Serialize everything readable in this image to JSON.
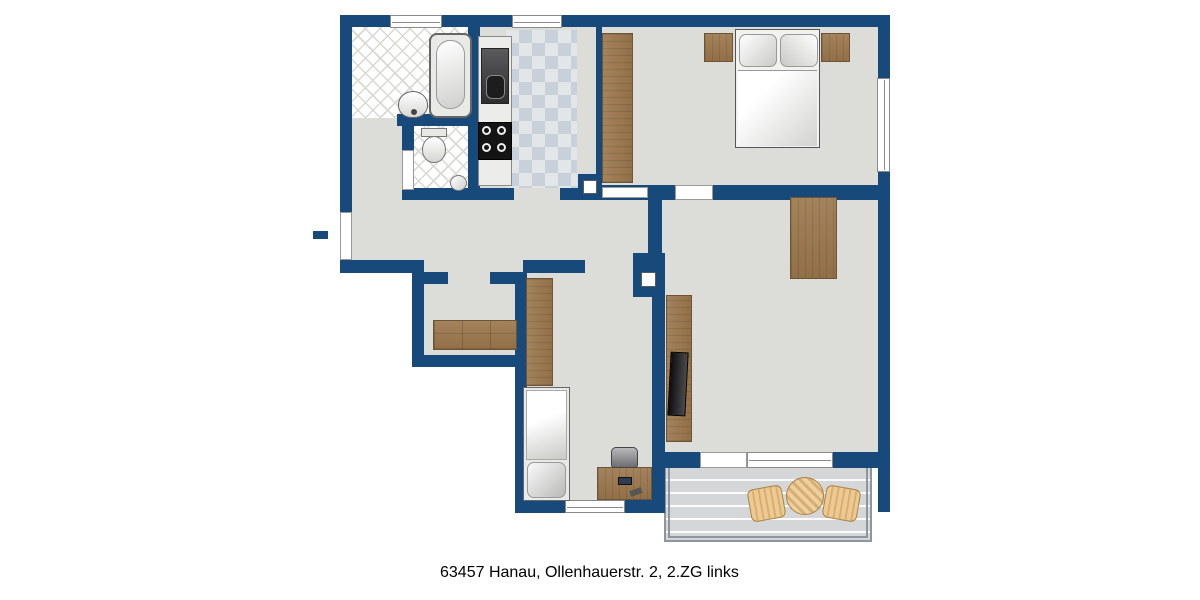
{
  "caption": "63457 Hanau, Ollenhauerstr. 2, 2.ZG links",
  "rooms": {
    "bad": {
      "label": "Bad"
    },
    "wc": {
      "label": "WC"
    },
    "kueche": {
      "label": "Küche"
    },
    "schlafen": {
      "label": "Schlafen"
    },
    "flur": {
      "label": "Flur"
    },
    "abstell": {
      "label": "Abstell."
    },
    "kind": {
      "label": "Kind"
    },
    "wohnen": {
      "label": "Wohnen"
    },
    "loggia": {
      "label": "Loggia"
    }
  },
  "colors": {
    "wall": "#17497B",
    "floor": "#DCDCD9",
    "wood": "#9C7C54",
    "tan_upholstery": "#EAD2A1",
    "dark_upholstery": "#3A3A3C",
    "bath_tile": "#FFFFFF",
    "kitchen_tile": "#C8D1D9"
  },
  "furniture": {
    "bad": [
      "bathtub",
      "washbasin"
    ],
    "wc": [
      "toilet",
      "corner-washbasin",
      "radiator"
    ],
    "kueche": [
      "kitchen-counter",
      "sink-unit",
      "stove"
    ],
    "schlafen": [
      "wardrobe",
      "double-bed",
      "nightstand-left",
      "nightstand-right"
    ],
    "abstell": [
      "shelf",
      "radiator"
    ],
    "kind": [
      "wardrobe",
      "single-bed",
      "desk",
      "desk-chair"
    ],
    "wohnen": [
      "dining-table",
      "dining-chairs-x4",
      "tv-cabinet",
      "tv",
      "armchair-x2",
      "coffee-table",
      "sofa"
    ],
    "loggia": [
      "round-table",
      "chair-x2"
    ]
  },
  "entrance": {
    "symbol": "arrow-right"
  }
}
